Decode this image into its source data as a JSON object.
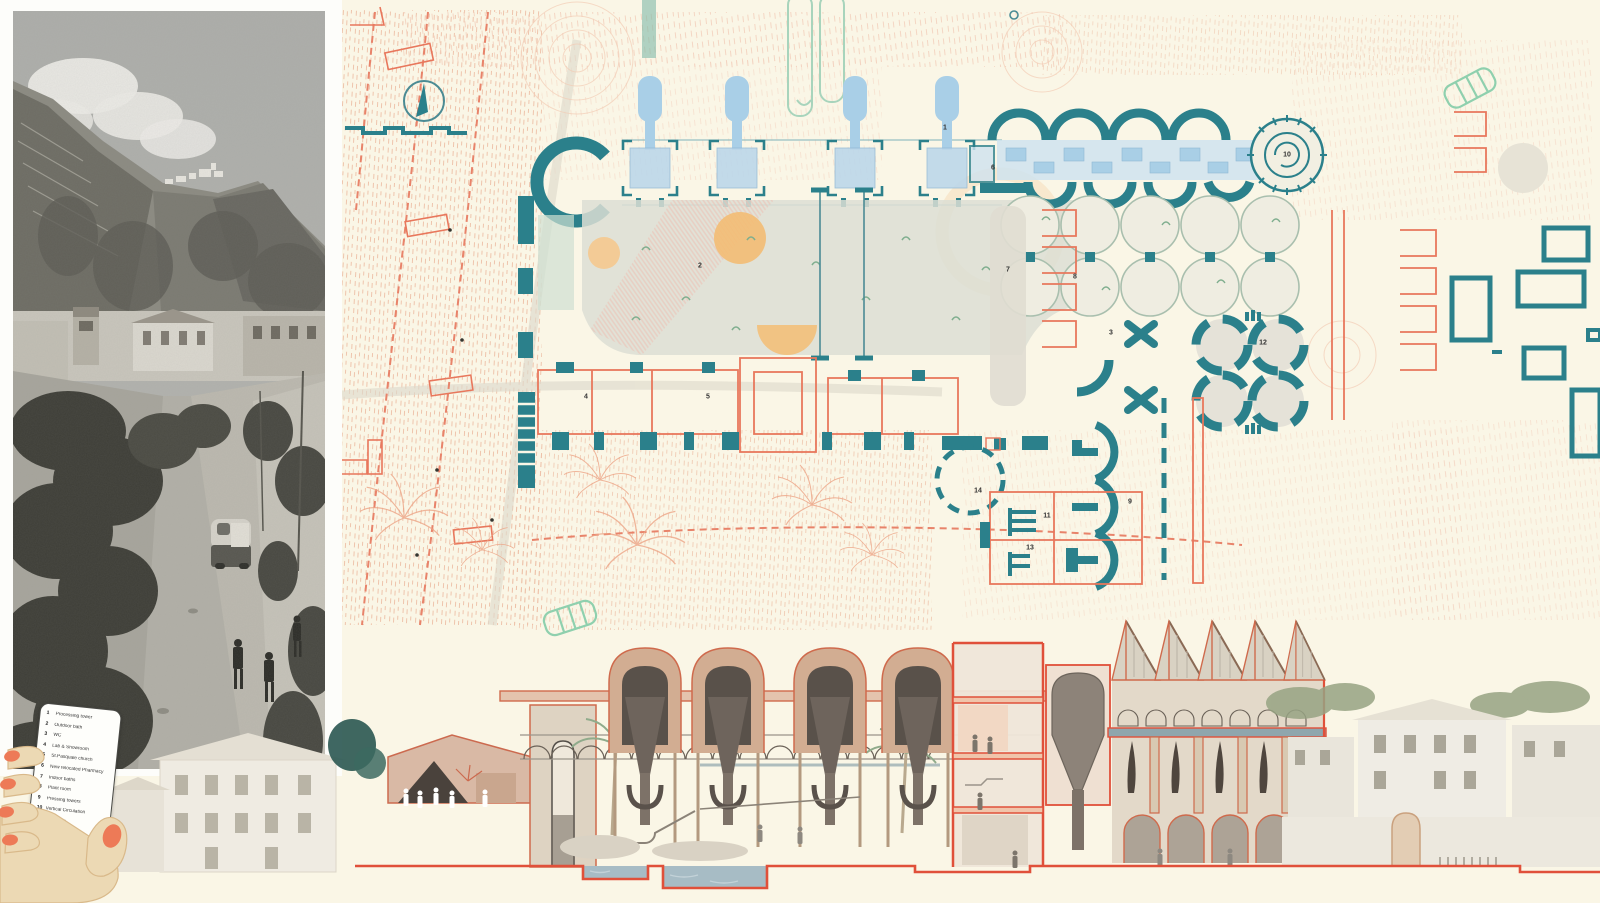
{
  "legend": {
    "items": [
      {
        "num": "1",
        "label": "Processing tower"
      },
      {
        "num": "2",
        "label": "Outdoor bath"
      },
      {
        "num": "3",
        "label": "WC"
      },
      {
        "num": "4",
        "label": "Lab & Showroom"
      },
      {
        "num": "5",
        "label": "St.Pasquale church"
      },
      {
        "num": "6",
        "label": "New relocated Pharmacy"
      },
      {
        "num": "7",
        "label": "Indoor baths"
      },
      {
        "num": "8",
        "label": "Plant room"
      },
      {
        "num": "9",
        "label": "Pressing towers"
      },
      {
        "num": "10",
        "label": "Vertical Circulation"
      },
      {
        "num": "11",
        "label": "Workshop"
      },
      {
        "num": "12",
        "label": "Caldarium"
      },
      {
        "num": "13",
        "label": "Changing room"
      },
      {
        "num": "14",
        "label": "Reception"
      }
    ]
  },
  "colors": {
    "teal": "#2b808b",
    "coral_line": "#e8775c",
    "section_cut": "#e0503a",
    "cream": "#faf6e6",
    "light_blue": "#aacfe7",
    "pale_green": "#a8d4bc",
    "orange": "#f3bd74",
    "water": "#a7bcc5",
    "pool_gray": "#dcded4"
  }
}
